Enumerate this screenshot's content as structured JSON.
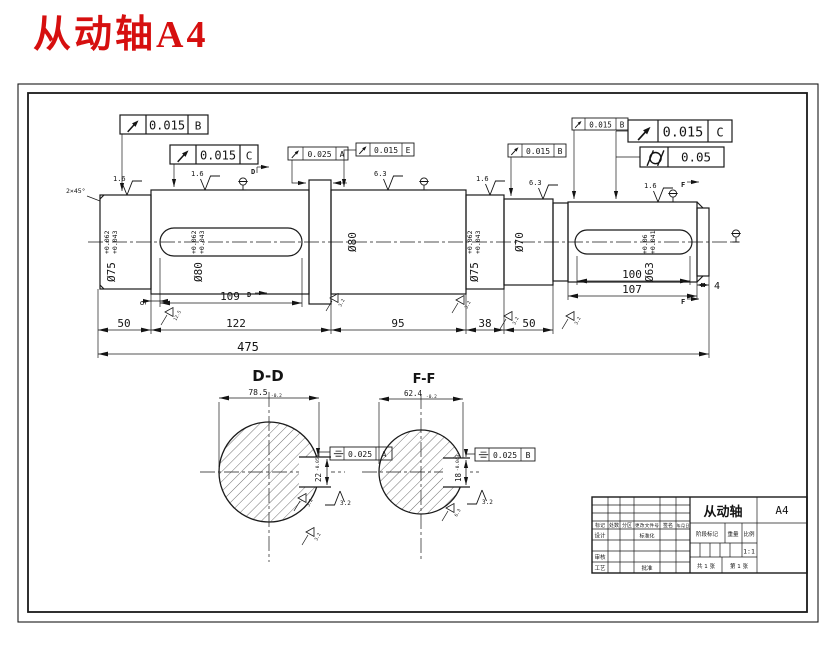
{
  "page": {
    "title": "从动轴A4",
    "title_color": "#d60f0f"
  },
  "fcf": {
    "f1": {
      "symbol": "circular-runout",
      "value": "0.015",
      "datum": "B"
    },
    "f2": {
      "symbol": "circular-runout",
      "value": "0.015",
      "datum": "C"
    },
    "f3": {
      "symbol": "circular-runout",
      "value": "0.025",
      "datum": "A"
    },
    "f4": {
      "symbol": "circular-runout",
      "value": "0.015",
      "datum": "E"
    },
    "f5": {
      "symbol": "circular-runout",
      "value": "0.015",
      "datum": "B"
    },
    "f6": {
      "symbol": "circular-runout",
      "value": "0.015",
      "datum": "B"
    },
    "f7": {
      "symbol": "circular-runout",
      "value": "0.015",
      "datum": "C"
    },
    "f8": {
      "symbol": "cylindricity",
      "value": "0.05"
    },
    "f9": {
      "symbol": "symmetry",
      "value": "0.025",
      "datum": "A"
    },
    "f10": {
      "symbol": "symmetry",
      "value": "0.025",
      "datum": "B"
    }
  },
  "shaft": {
    "chamfer_note": "2×45°",
    "labels": {
      "s1_dia": "Ø75",
      "s1_hi": "+0.062",
      "s1_lo": "+0.043",
      "s2_dia": "Ø80",
      "s2_hi": "+0.062",
      "s2_lo": "+0.043",
      "s3_dia": "Ø80",
      "s4_dia": "Ø75",
      "s4_hi": "+0.062",
      "s4_lo": "+0.043",
      "s5_dia": "Ø70",
      "s6_dia": "Ø63",
      "s6_hi": "+0.06",
      "s6_lo": "+0.041"
    },
    "dims": {
      "d9": "9",
      "d109": "109",
      "d50a": "50",
      "d122": "122",
      "d95": "95",
      "d38": "38",
      "d50b": "50",
      "d475": "475",
      "d100": "100",
      "d107": "107",
      "d4": "4"
    },
    "roughness": {
      "r1": "1.6",
      "r2": "1.6",
      "r3": "6.3",
      "r4": "1.6",
      "r5": "6.3",
      "r6": "1.6"
    },
    "marks": [
      "12.5",
      "3.2",
      "3.2",
      "3.2",
      "3.2"
    ],
    "cut_d": "D",
    "cut_f": "F"
  },
  "sections": {
    "dd": {
      "title": "D-D",
      "width": "78.5",
      "width_tol": "-0.2",
      "key": "22",
      "key_tol": "-0.052",
      "rough": "3.2",
      "m1": "3.2",
      "m2": "3.2"
    },
    "ff": {
      "title": "F-F",
      "width": "62.4",
      "width_tol": "-0.2",
      "key": "18",
      "key_tol": "-0.043",
      "rough": "3.2",
      "m1": "6.3"
    }
  },
  "title_block": {
    "part": "从动轴",
    "size": "A4",
    "h1": "标记",
    "h2": "处数",
    "h3": "分区",
    "h4": "更改文件号",
    "h5": "签名",
    "h6": "年、月、日",
    "design": "设计",
    "standardize": "标准化",
    "audit": "审核",
    "process": "工艺",
    "approve": "批准",
    "stage": "阶段标记",
    "weight": "重量",
    "scale_label": "比例",
    "scale": "1:1",
    "total": "共 1 张",
    "page": "第 1 张"
  }
}
